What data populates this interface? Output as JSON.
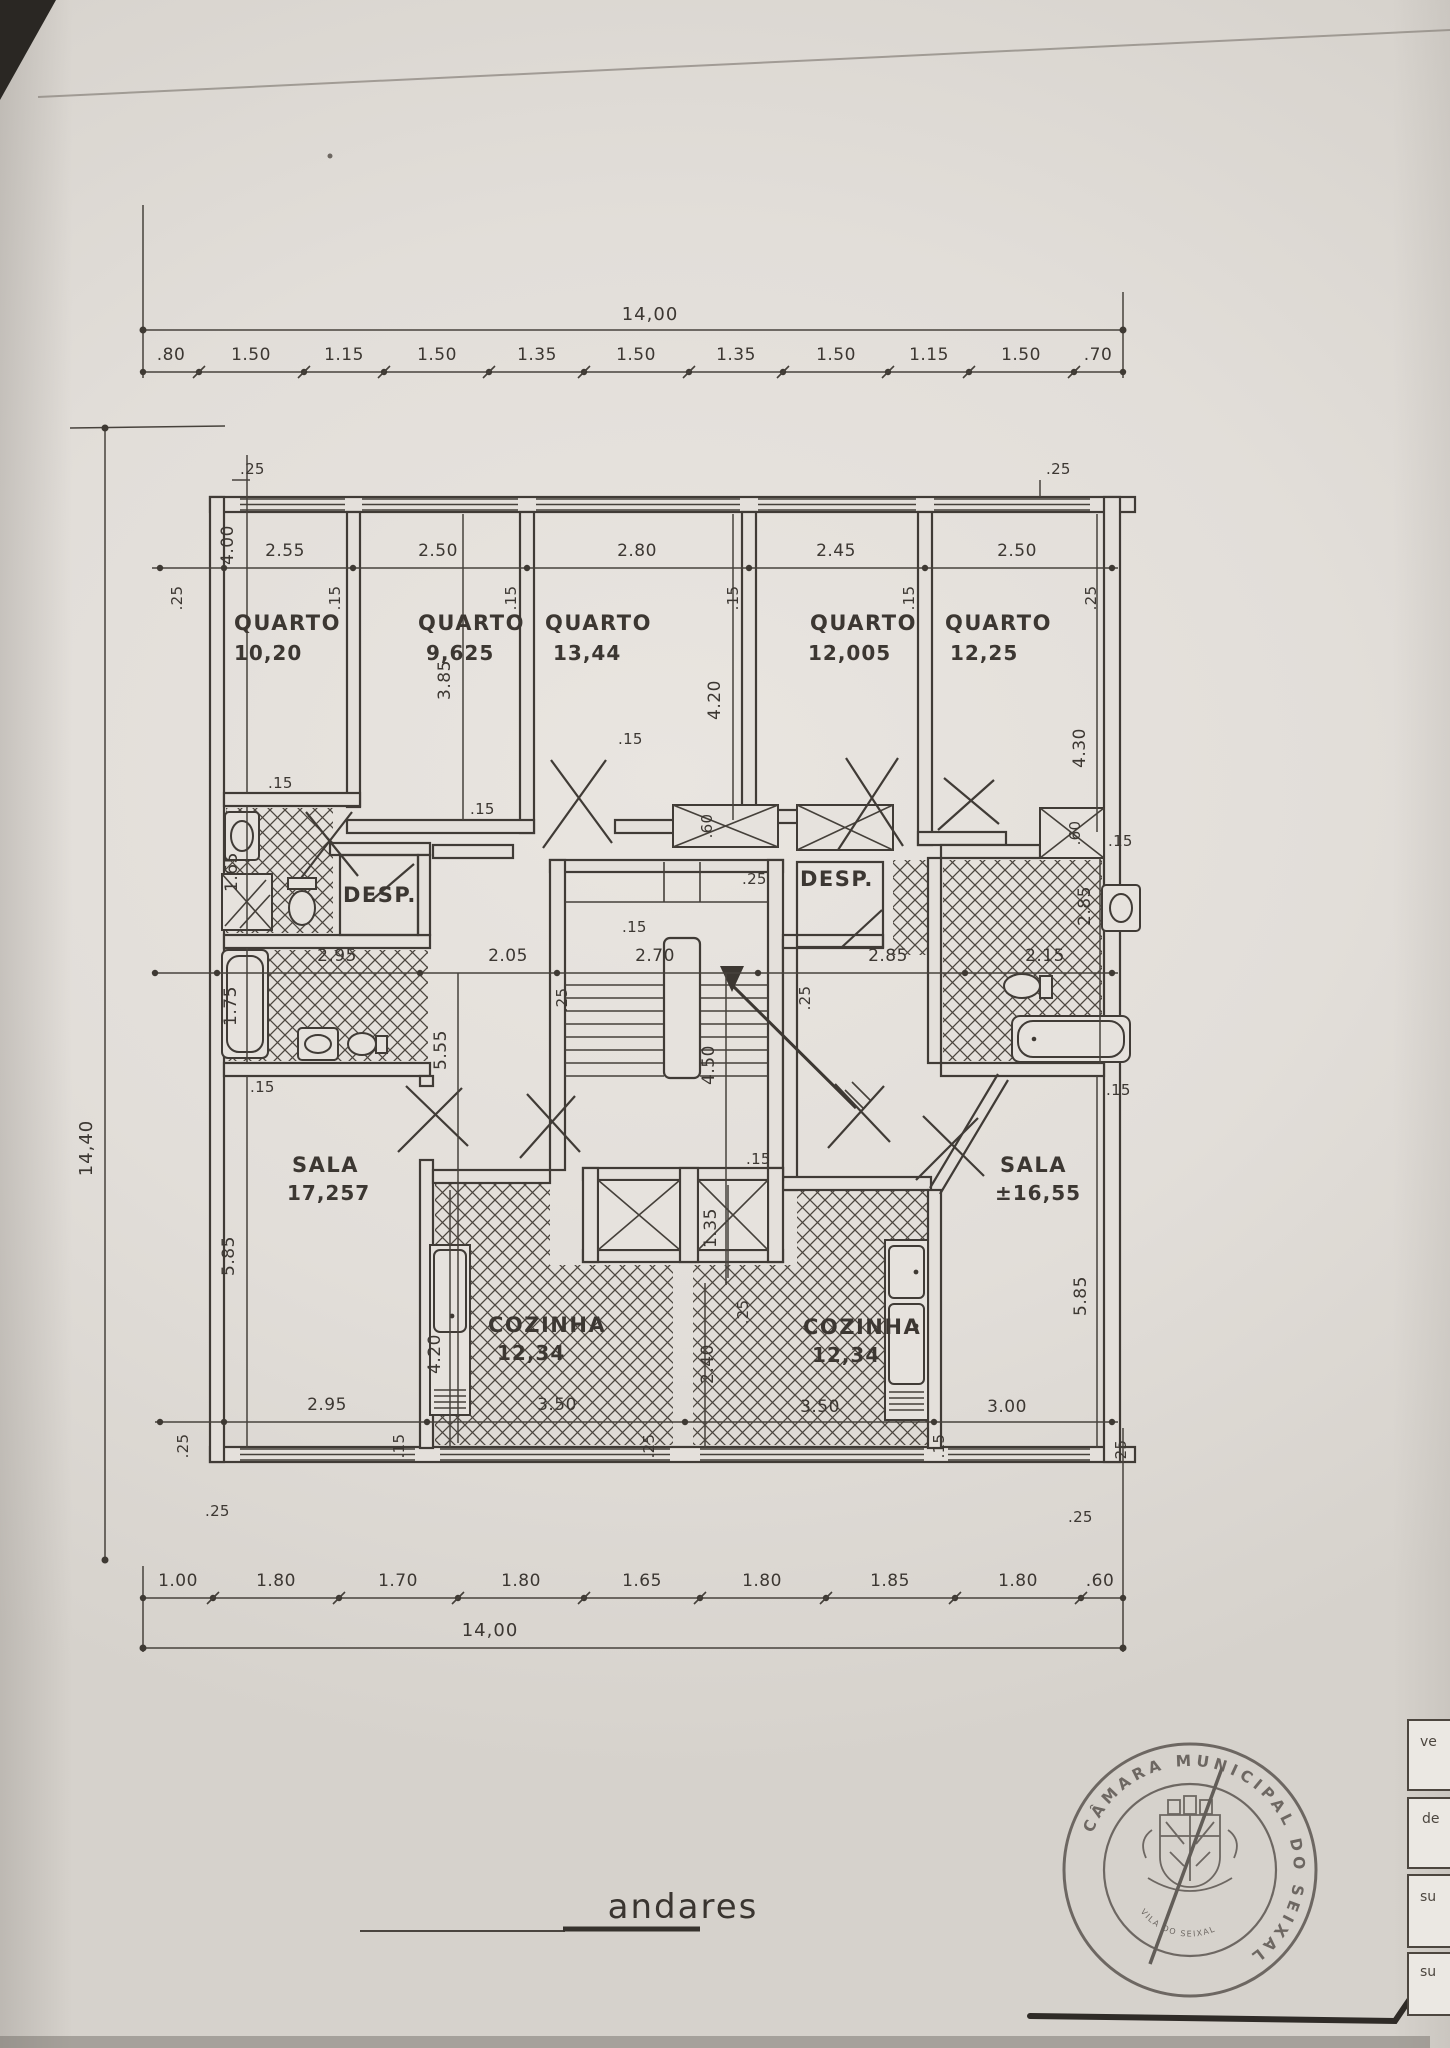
{
  "title": {
    "label": "andares"
  },
  "rooms": {
    "quarto1": {
      "name": "QUARTO",
      "area": "10,20"
    },
    "quarto2": {
      "name": "QUARTO",
      "area": "9,625"
    },
    "quarto3": {
      "name": "QUARTO",
      "area": "13,44"
    },
    "quarto4": {
      "name": "QUARTO",
      "area": "12,005"
    },
    "quarto5": {
      "name": "QUARTO",
      "area": "12,25"
    },
    "desp1": {
      "name": "DESP."
    },
    "desp2": {
      "name": "DESP."
    },
    "sala1": {
      "name": "SALA",
      "area": "17,257"
    },
    "sala2": {
      "name": "SALA",
      "area": "±16,55"
    },
    "cozinha1": {
      "name": "COZINHA",
      "area": "12,34"
    },
    "cozinha2": {
      "name": "COZINHA",
      "area": "12,34"
    }
  },
  "dims": {
    "top_total": "14,00",
    "bottom_total": "14,00",
    "left_total": "14,40",
    "top_chain": [
      ".80",
      "1.50",
      "1.15",
      "1.50",
      "1.35",
      "1.50",
      "1.35",
      "1.50",
      "1.15",
      "1.50",
      ".70"
    ],
    "bottom_chain": [
      "1.00",
      "1.80",
      "1.70",
      "1.80",
      "1.65",
      "1.80",
      "1.85",
      "1.80",
      ".60"
    ],
    "room_widths": [
      "2.55",
      "2.50",
      "2.80",
      "2.45",
      "2.50"
    ],
    "depths": {
      "quarto1": "4.00",
      "quarto2": "3.85",
      "quarto3": "4.20",
      "quarto5": "4.30"
    },
    "mid_widths": [
      "2.95",
      "2.05",
      "2.70",
      "2.85",
      "2.15"
    ],
    "lower_widths": [
      "2.95",
      "3.50",
      "3.50",
      "3.00"
    ],
    "verticals": {
      "hall": "5.55",
      "stair": "4.50",
      "sala1": "5.85",
      "sala2": "5.85",
      "kitchen1": "4.20",
      "kitchen2": "2.40",
      "shaft": "1.35",
      "bath_top": "1.65",
      "bath_bottom": "1.75",
      "bath_right": "2.85"
    },
    "wall_thin": ".15",
    "wall_thick": ".25",
    "duct": ".60"
  },
  "stamp": {
    "ring_text": "CÂMARA MUNICIPAL DO SEIXAL",
    "center_text": "VILA DO SEIXAL"
  },
  "side_tabs": [
    "ve",
    "de",
    "su",
    "su"
  ]
}
